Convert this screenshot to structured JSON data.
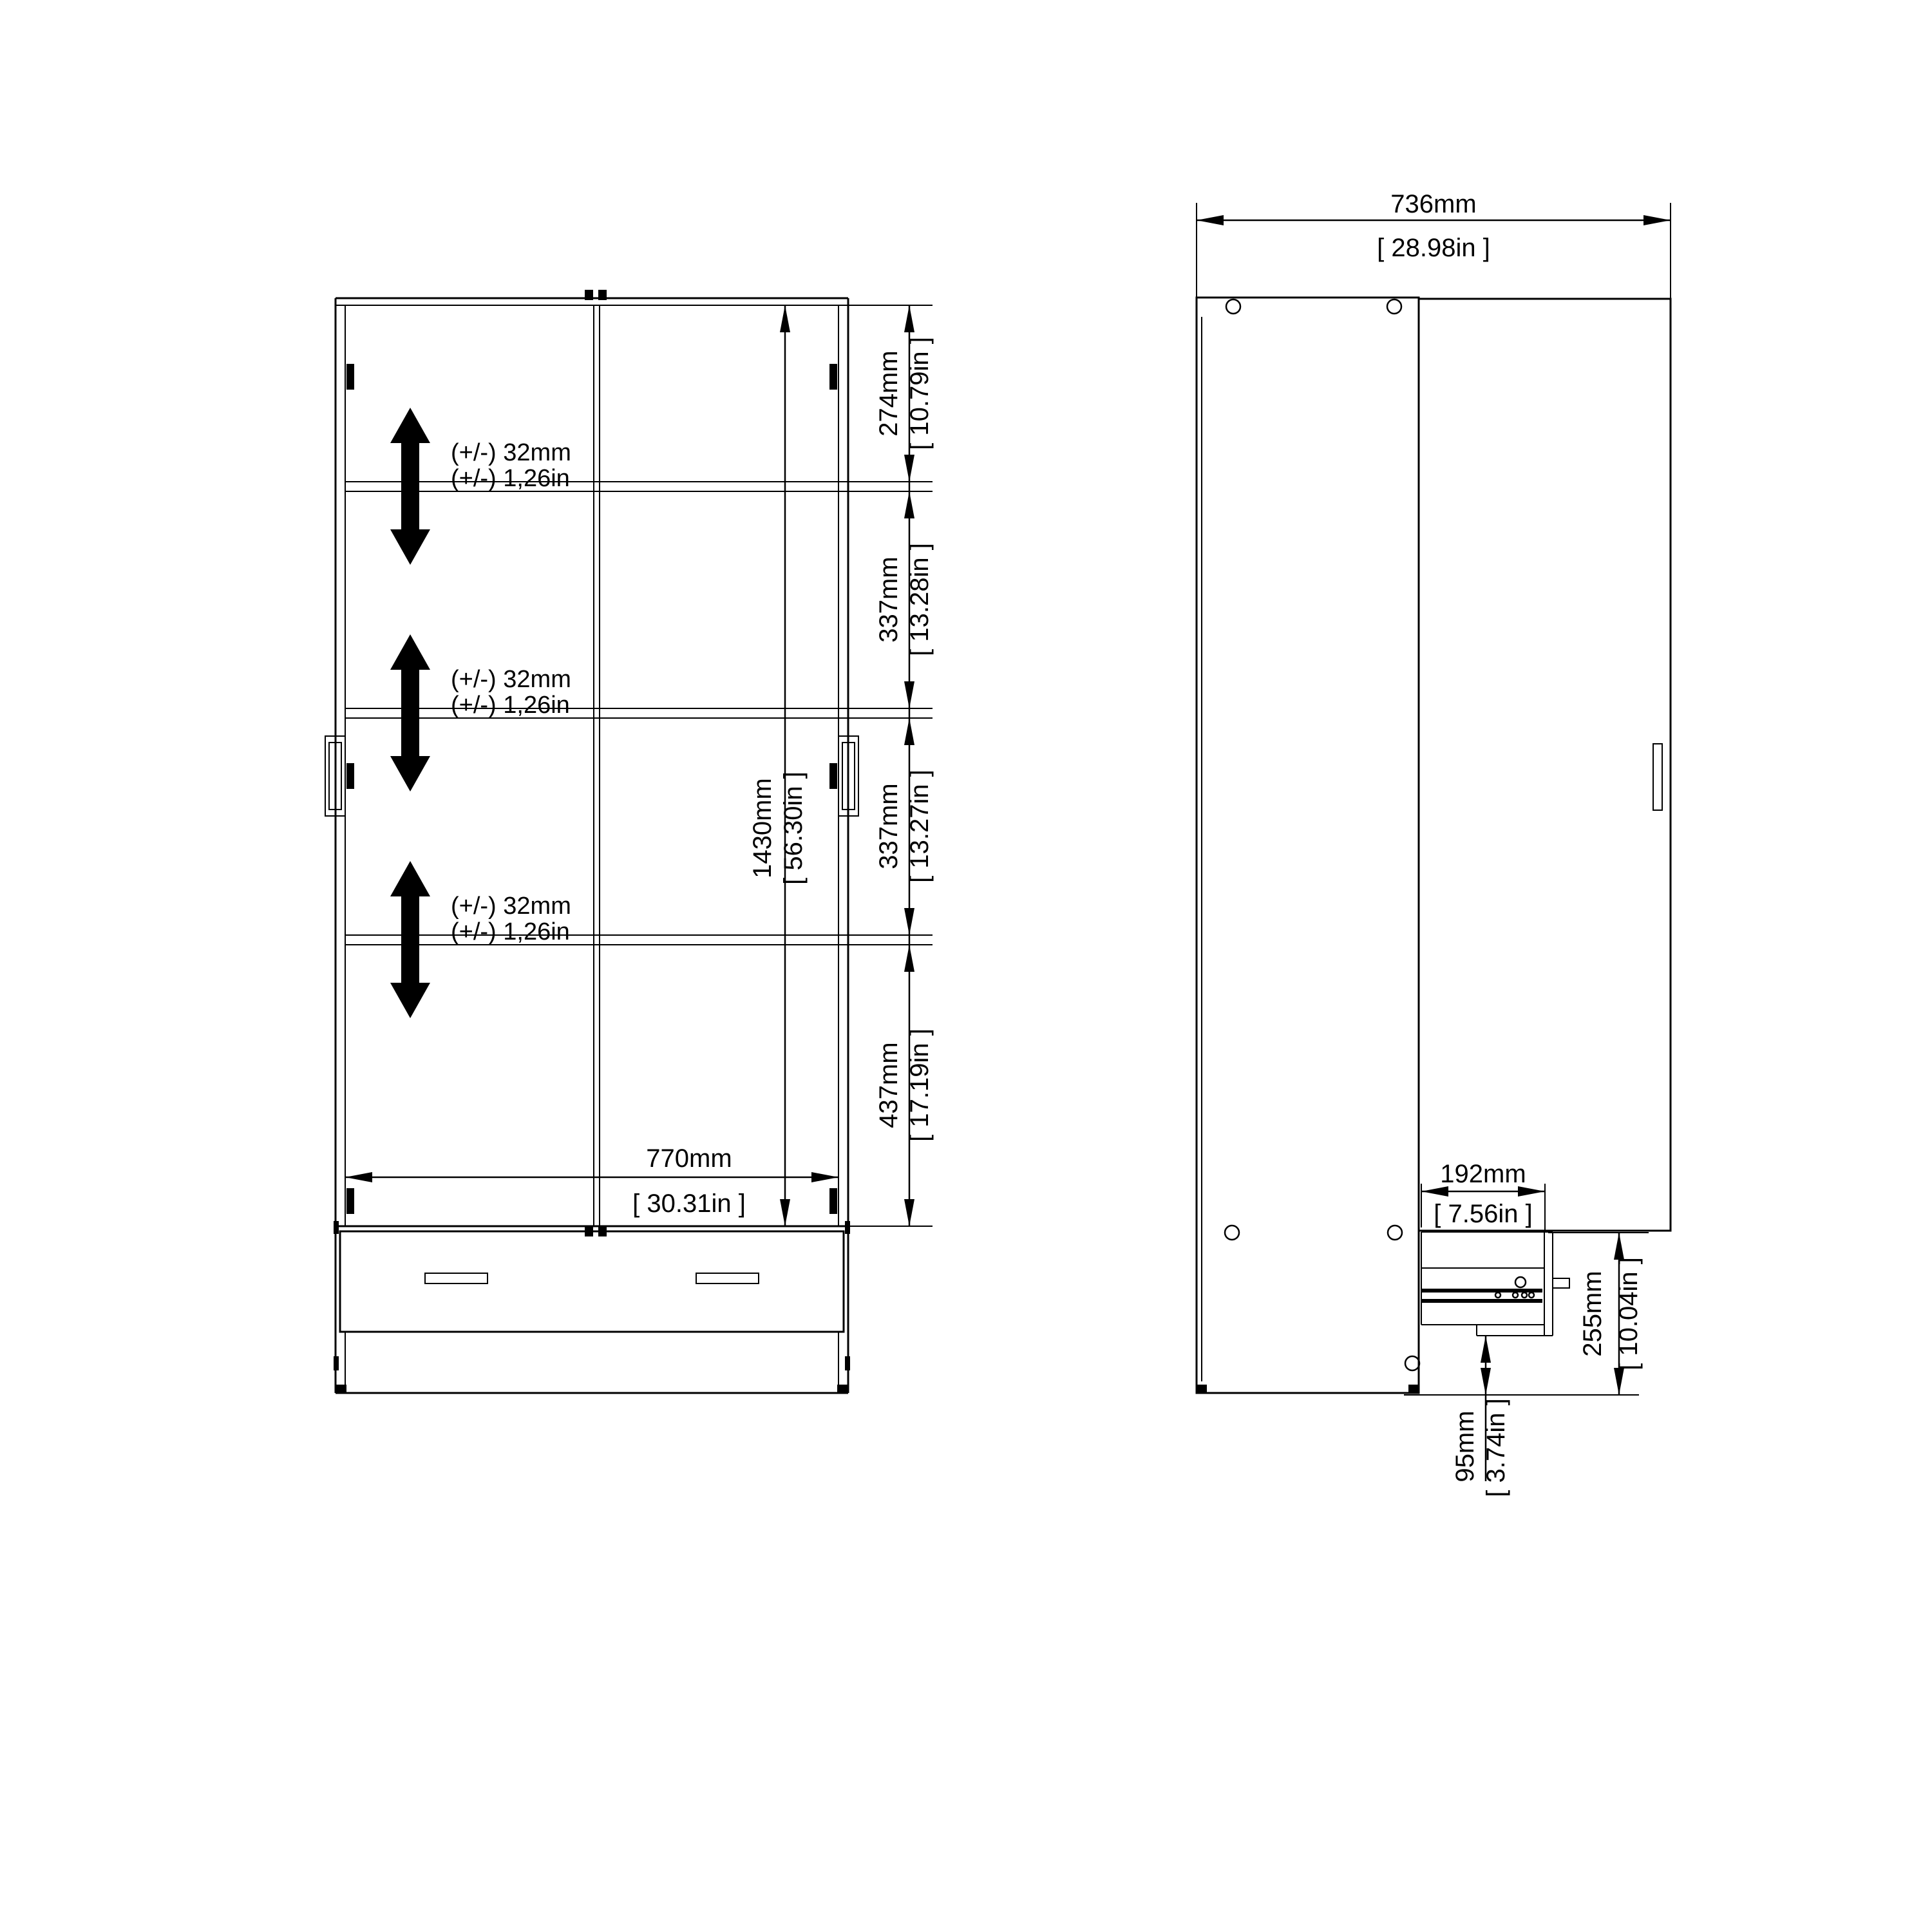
{
  "drawing": {
    "type": "furniture-technical-drawing",
    "views": [
      "front-section",
      "side-section"
    ],
    "colors": {
      "line": "#000000",
      "background": "#ffffff"
    }
  },
  "front_view": {
    "tolerances": [
      {
        "line1": "(+/-) 32mm",
        "line2": "(+/-) 1,26in"
      },
      {
        "line1": "(+/-) 32mm",
        "line2": "(+/-) 1,26in"
      },
      {
        "line1": "(+/-) 32mm",
        "line2": "(+/-) 1,26in"
      }
    ],
    "dim_274": {
      "mm": "274mm",
      "inch": "[ 10.79in ]"
    },
    "dim_337a": {
      "mm": "337mm",
      "inch": "[ 13.28in ]"
    },
    "dim_337b": {
      "mm": "337mm",
      "inch": "[ 13.27in ]"
    },
    "dim_437": {
      "mm": "437mm",
      "inch": "[ 17.19in ]"
    },
    "dim_1430": {
      "mm": "1430mm",
      "inch": "[ 56.30in ]"
    },
    "dim_770": {
      "mm": "770mm",
      "inch": "[ 30.31in ]"
    }
  },
  "side_view": {
    "dim_736": {
      "mm": "736mm",
      "inch": "[ 28.98in ]"
    },
    "dim_192": {
      "mm": "192mm",
      "inch": "[ 7.56in ]"
    },
    "dim_255": {
      "mm": "255mm",
      "inch": "[ 10.04in ]"
    },
    "dim_95": {
      "mm": "95mm",
      "inch": "[ 3.74in ]"
    }
  }
}
